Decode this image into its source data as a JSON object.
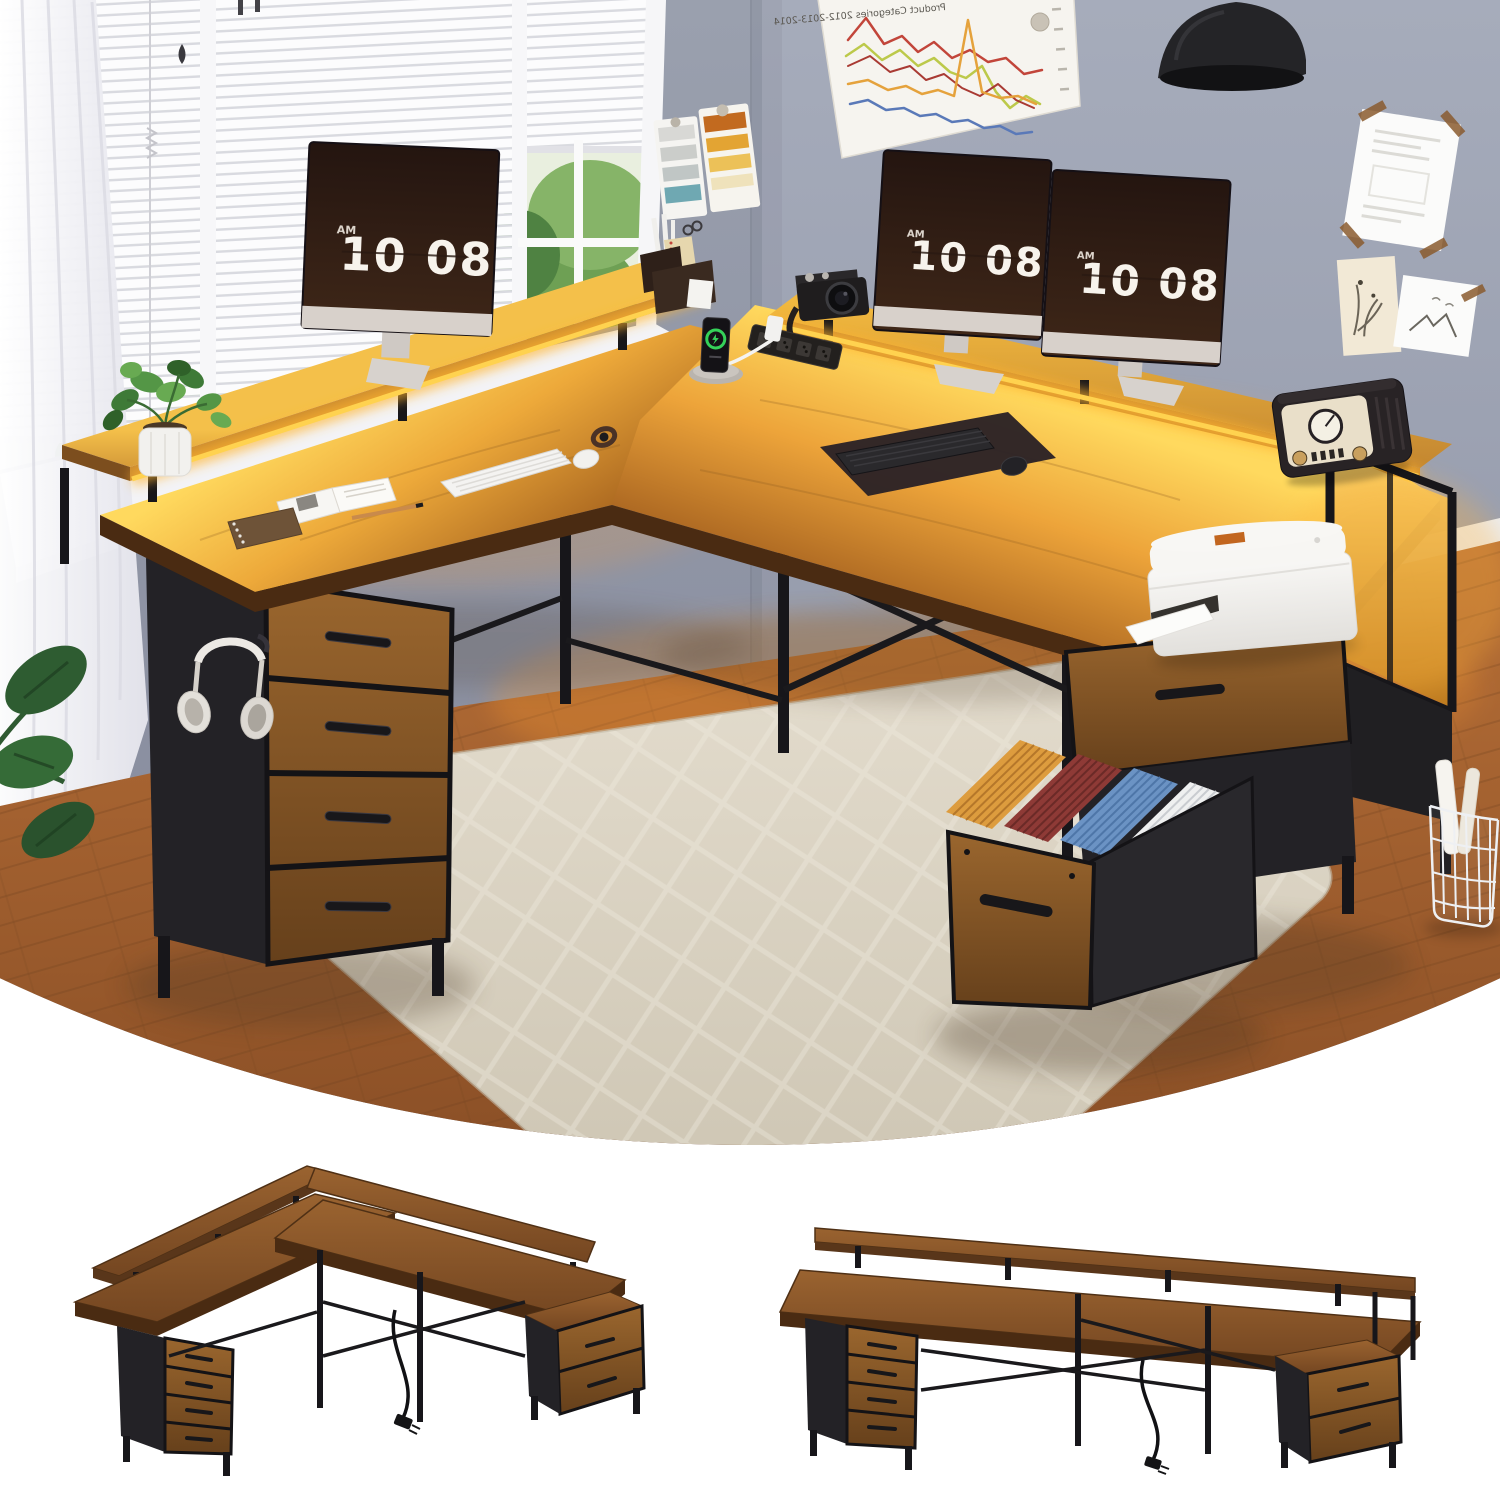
{
  "hero": {
    "clock": {
      "ampm": "AM",
      "time": "10 08"
    },
    "poster": {
      "title": "Product Categories 2012-2013-2014",
      "mirrored": true,
      "line_colors": [
        "#c2453a",
        "#a93a33",
        "#bcc94a",
        "#e5a23c",
        "#5a79b8"
      ]
    },
    "monitor_count": 3,
    "file_folder_colors": [
      "#dd9c3e",
      "#8e3a36",
      "#6b93c4",
      "#eff0f0"
    ]
  },
  "palette": {
    "wood": "#b5722f",
    "wood_dark": "#5f3a1c",
    "led_glow": "#ffc948",
    "wall": "#9499a8",
    "metal_black": "#1d1c1f",
    "rug": "#dcd5c6",
    "floor": "#a96532",
    "screen": "#2e1d14",
    "charge_green": "#35d159"
  },
  "views": {
    "hero": "l-shaped-desk-room-scene",
    "config_left": "l-shaped-configuration",
    "config_right": "straight-configuration"
  }
}
